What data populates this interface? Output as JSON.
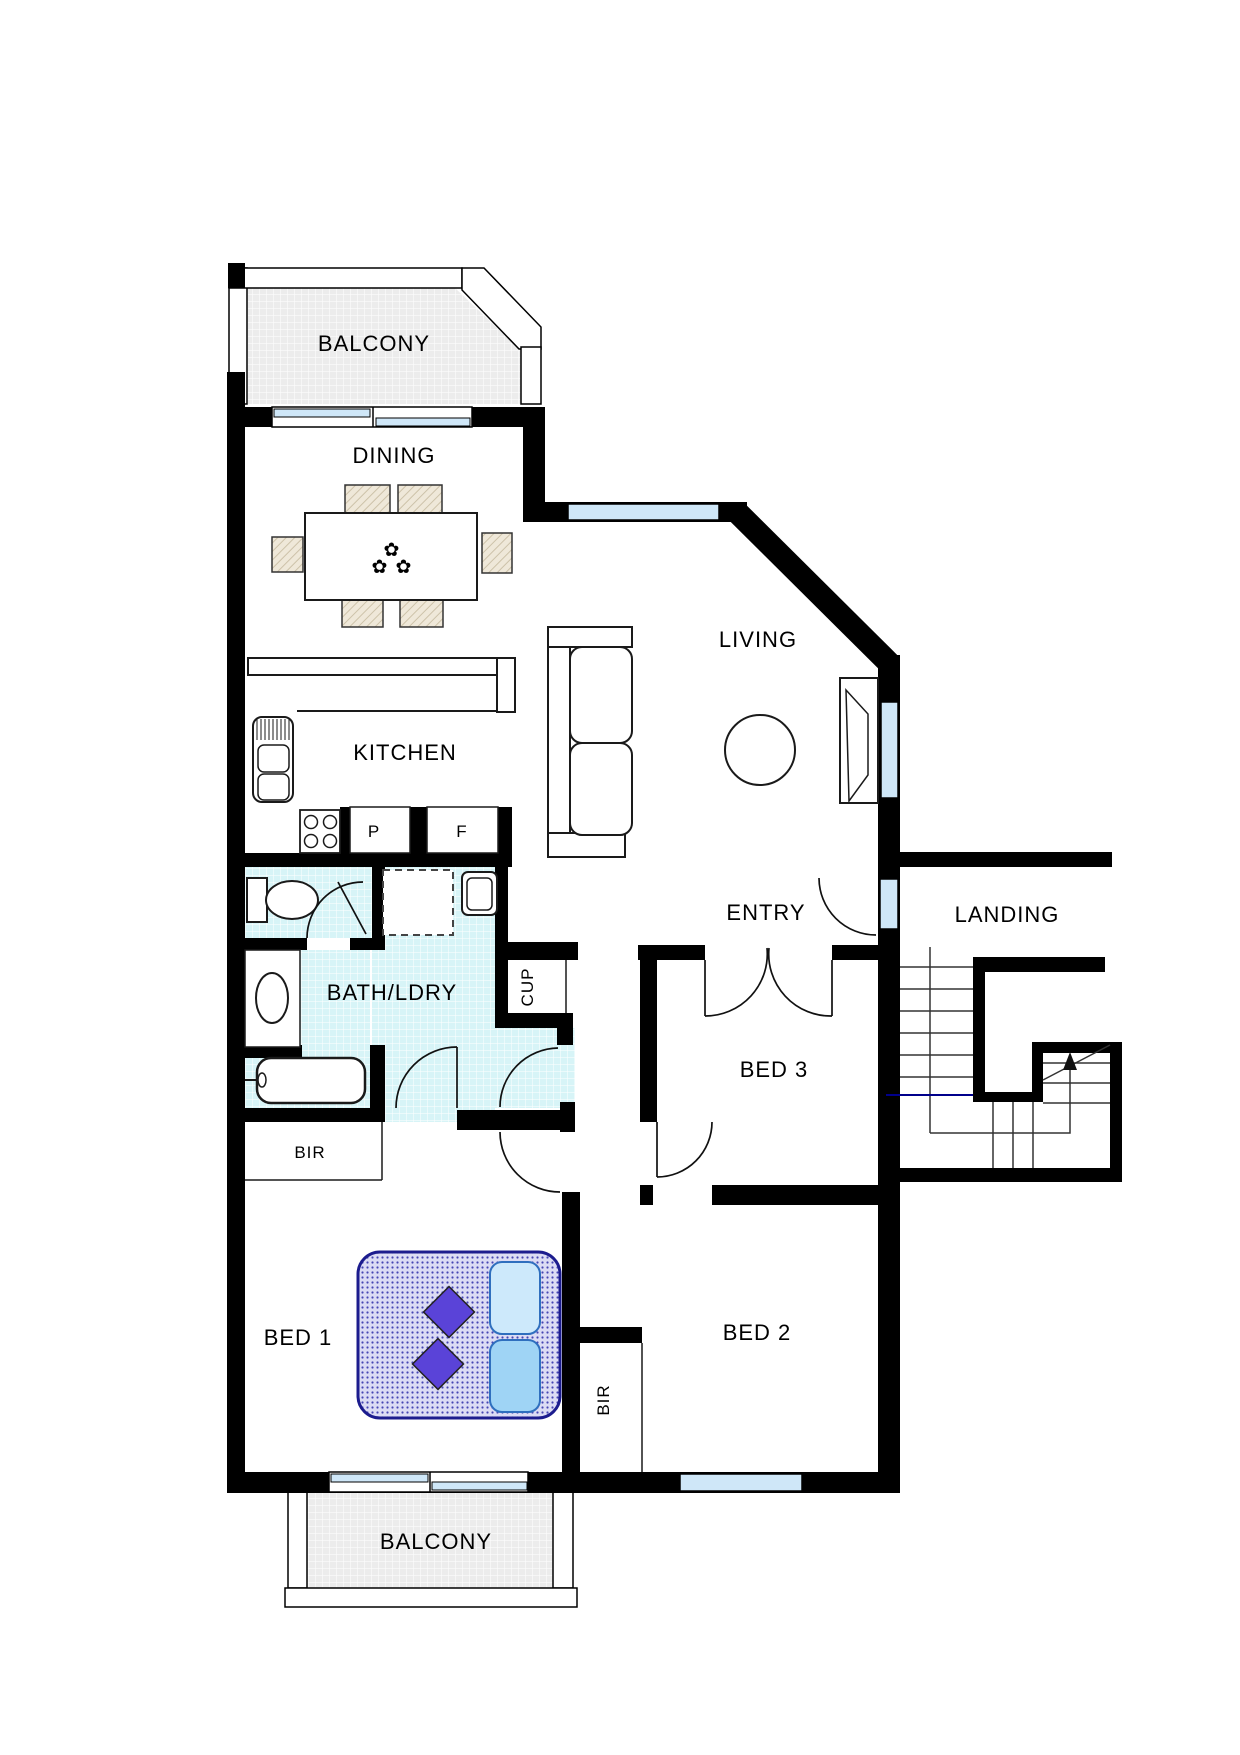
{
  "labels": {
    "balcony_top": "BALCONY",
    "dining": "DINING",
    "living": "LIVING",
    "kitchen": "KITCHEN",
    "pantry": "P",
    "fridge": "F",
    "bath_ldry": "BATH/LDRY",
    "cup": "CUP",
    "entry": "ENTRY",
    "landing": "LANDING",
    "bed3": "BED 3",
    "bir_bed1": "BIR",
    "bed1": "BED 1",
    "bir_bed2": "BIR",
    "bed2": "BED 2",
    "balcony_bottom": "BALCONY"
  },
  "icons": {
    "flower": "✿"
  },
  "colors": {
    "wall": "#000000",
    "window": "#cfe7f8",
    "tile": "#d7f4f7",
    "balcony_floor": "#ececec",
    "bed_border": "#1c1c8e",
    "pillow_light": "#cde9fb",
    "pillow_dark": "#9fd4f5",
    "diamond": "#5a43d8",
    "flower": "#ee2fb6",
    "stair_marker": "#00008b"
  }
}
